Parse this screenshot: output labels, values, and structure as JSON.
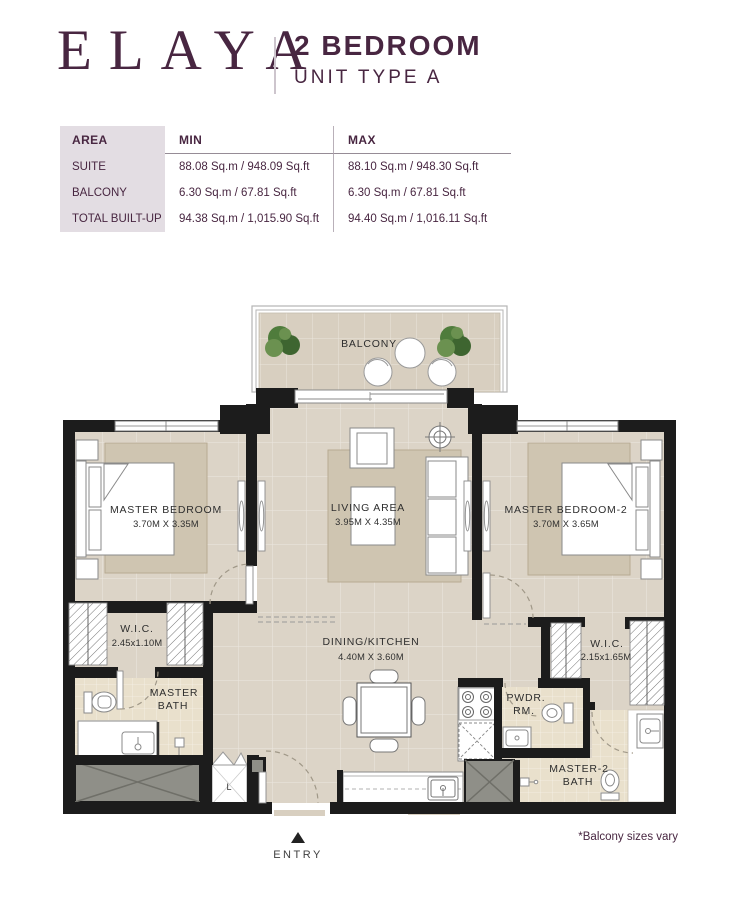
{
  "header": {
    "brand": "ELAYA",
    "title_line1": "2 BEDROOM",
    "title_line2": "UNIT TYPE A"
  },
  "area_table": {
    "col_headers": {
      "area": "AREA",
      "min": "MIN",
      "max": "MAX"
    },
    "rows": [
      {
        "label": "SUITE",
        "min": "88.08 Sq.m / 948.09 Sq.ft",
        "max": "88.10 Sq.m / 948.30 Sq.ft"
      },
      {
        "label": "BALCONY",
        "min": "6.30 Sq.m / 67.81 Sq.ft",
        "max": "6.30 Sq.m / 67.81 Sq.ft"
      },
      {
        "label": "TOTAL BUILT-UP",
        "min": "94.38 Sq.m / 1,015.90 Sq.ft",
        "max": "94.40 Sq.m / 1,016.11 Sq.ft"
      }
    ]
  },
  "floorplan": {
    "balcony": {
      "label": "BALCONY"
    },
    "master_bedroom": {
      "name": "MASTER BEDROOM",
      "dims": "3.70M X 3.35M"
    },
    "living_area": {
      "name": "LIVING AREA",
      "dims": "3.95M X 4.35M"
    },
    "master_bedroom_2": {
      "name": "MASTER BEDROOM-2",
      "dims": "3.70M X 3.65M"
    },
    "wic_1": {
      "name": "W.I.C.",
      "dims": "2.45x1.10M"
    },
    "master_bath": {
      "line1": "MASTER",
      "line2": "BATH"
    },
    "dining_kitchen": {
      "name": "DINING/KITCHEN",
      "dims": "4.40M X 3.60M"
    },
    "powder_room": {
      "line1": "PWDR.",
      "line2": "RM."
    },
    "wic_2": {
      "name": "W.I.C.",
      "dims": "2.15x1.65M"
    },
    "master2_bath": {
      "line1": "MASTER-2",
      "line2": "BATH"
    },
    "laundry": {
      "label": "L"
    },
    "entry": {
      "label": "ENTRY"
    }
  },
  "footnote": "*Balcony sizes vary",
  "colors": {
    "brand_plum": "#482641",
    "table_label_bg": "#E3DDE3",
    "wall": "#1C1C1C",
    "floor_beige": "#DCD4C7",
    "bath_tile": "#E9E0CC",
    "rug": "#CFC5B1",
    "shaft_gray": "#8F8F88",
    "plant_green": "#4F7C3C"
  }
}
